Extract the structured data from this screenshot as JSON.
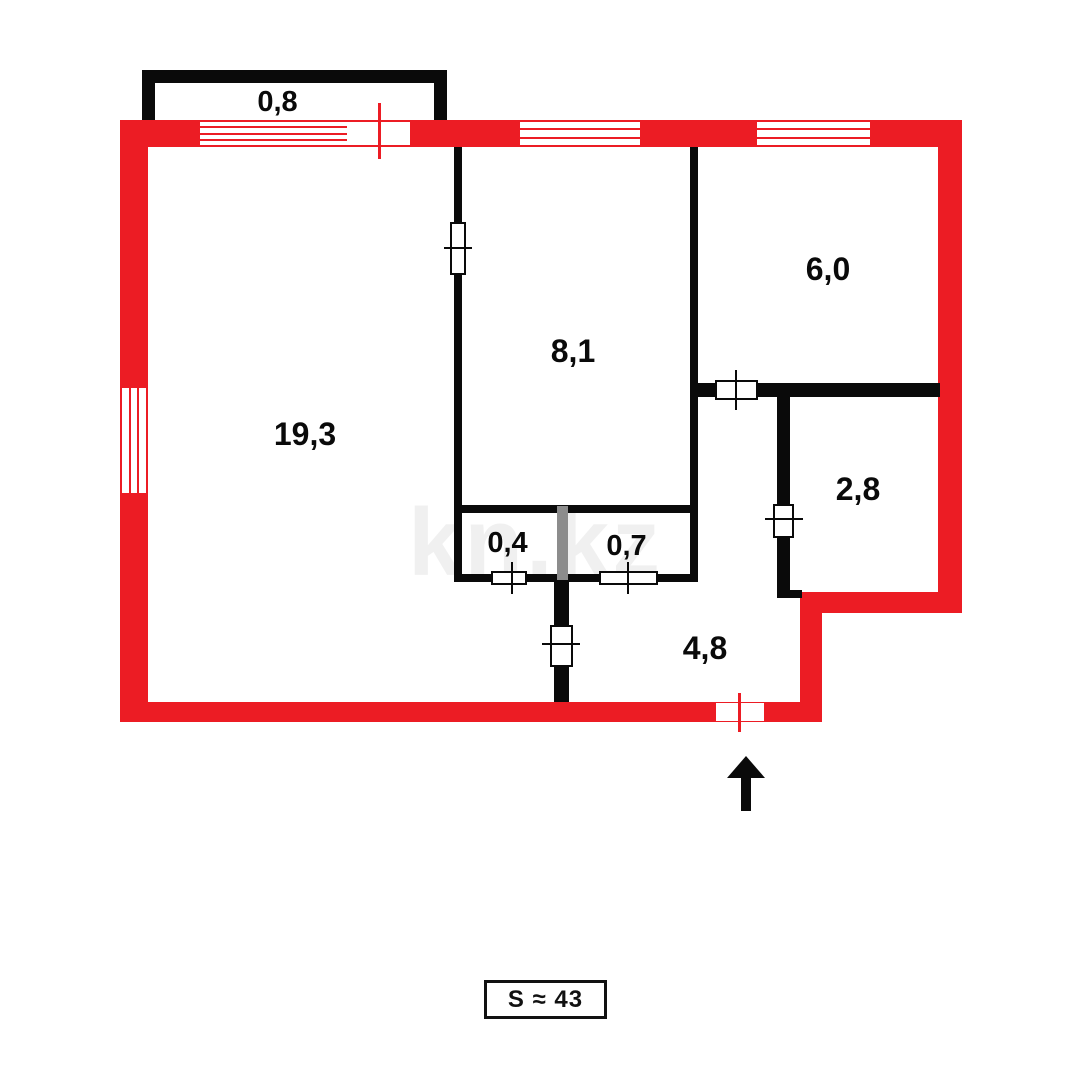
{
  "floorplan": {
    "watermark": "kn.kz",
    "total_area": {
      "label": "S ≈ 43"
    },
    "colors": {
      "exterior_wall": "#EC1C24",
      "interior_wall": "#0A0A0A",
      "partition": "#8C8C8C",
      "background": "#FFFFFF"
    },
    "rooms": [
      {
        "name": "balcony",
        "area_label": "0,8"
      },
      {
        "name": "living-room",
        "area_label": "19,3"
      },
      {
        "name": "room",
        "area_label": "8,1"
      },
      {
        "name": "kitchen",
        "area_label": "6,0"
      },
      {
        "name": "bathroom",
        "area_label": "2,8"
      },
      {
        "name": "closet-left",
        "area_label": "0,4"
      },
      {
        "name": "closet-right",
        "area_label": "0,7"
      },
      {
        "name": "hallway",
        "area_label": "4,8"
      }
    ],
    "entrance": {
      "direction": "up"
    }
  }
}
